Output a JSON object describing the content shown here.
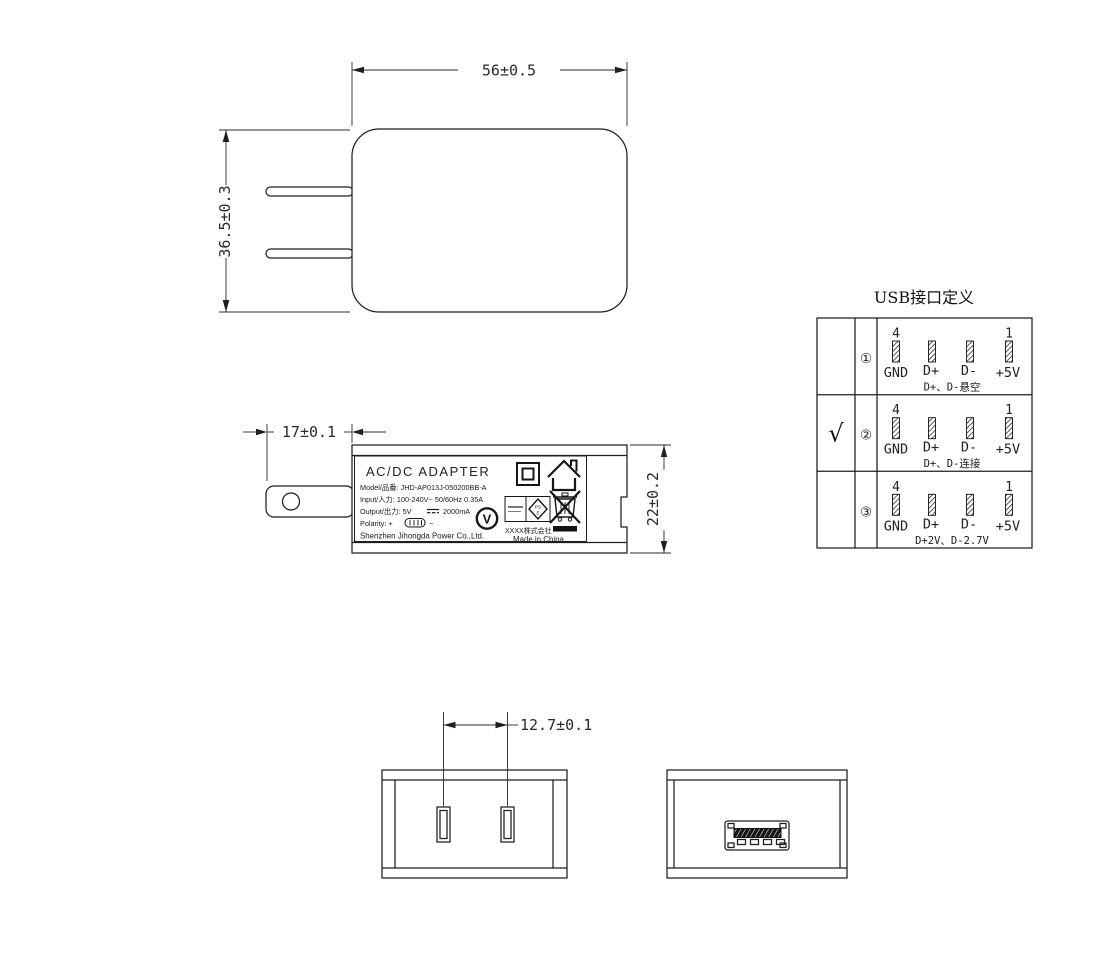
{
  "front_view": {
    "dim_width": "56±0.5",
    "dim_height": "36.5±0.3"
  },
  "side_view": {
    "dim_prong": "17±0.1",
    "dim_depth": "22±0.2",
    "label": {
      "title": "AC/DC  ADAPTER",
      "model": "Model/品番: JHD-AP013J-050200BB-A",
      "input": "Input/入力: 100-240V~  50/60Hz  0.35A",
      "output_prefix": "Output/出力: 5V",
      "output_suffix": "2000mA",
      "polarity_prefix": "Polarity:  +",
      "polarity_suffix": "−",
      "company": "Shenzhen Jihongda Power Co.,Ltd.",
      "efficiency_mark": "V",
      "pse_top": "PS",
      "pse_bottom": "E",
      "maker": "XXXX株式会社",
      "origin": "Made in China"
    }
  },
  "usb_table": {
    "title": "USB接口定义",
    "pin_first": "4",
    "pin_last": "1",
    "rows": [
      {
        "check": "",
        "num": "①",
        "labels": [
          "GND",
          "D+",
          "D-",
          "+5V"
        ],
        "note": "D+、D-悬空"
      },
      {
        "check": "√",
        "num": "②",
        "labels": [
          "GND",
          "D+",
          "D-",
          "+5V"
        ],
        "note": "D+、D-连接"
      },
      {
        "check": "",
        "num": "③",
        "labels": [
          "GND",
          "D+",
          "D-",
          "+5V"
        ],
        "note": "D+2V、D-2.7V"
      }
    ]
  },
  "bottom_views": {
    "dim_pitch": "12.7±0.1"
  }
}
